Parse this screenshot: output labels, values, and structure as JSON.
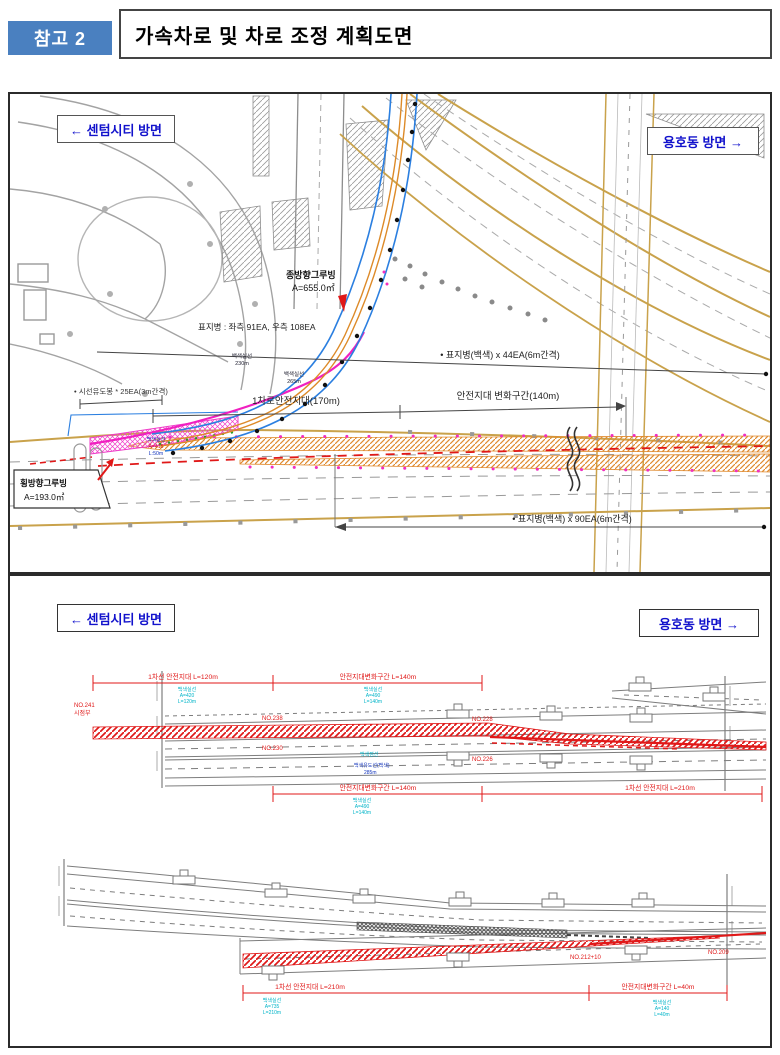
{
  "header": {
    "badge": "참고 2",
    "title": "가속차로 및 차로 조정 계획도면"
  },
  "panel_top": {
    "dir_left": "← 센텀시티 방면",
    "dir_right": "용호동 방면 →",
    "grooving_long_line1": "종방향그루빙",
    "grooving_long_line2": "A=655.0㎡",
    "stud_total": "표지병 : 좌측 91EA, 우측 108EA",
    "stud_white_44": "• 표지병(백색) x 44EA(6m간격)",
    "delineator_25": "• 시선유도봉 * 25EA(3m간격)",
    "lane1_safety_170": "1차로안전지대(170m)",
    "transition_140": "안전지대 변화구간(140m)",
    "stud_white_90": "• 표지병(백색) x 90EA(6m간격)",
    "grooving_cross_line1": "횡방향그루빙",
    "grooving_cross_line2": "A=193.0㎡",
    "white_solid_a_line1": "백색실선",
    "white_solid_a_line2": "230m",
    "white_solid_b_line1": "백색실선",
    "white_solid_b_line2": "265m",
    "white_solid_c_line1": "백색실선",
    "white_solid_c_line2": "A=415",
    "white_solid_c_line3": "L:50m"
  },
  "panel_bottom": {
    "dir_left": "← 센텀시티 방면",
    "dir_right": "용호동 방면 →",
    "d1": {
      "dim_top_left": "1차선 안전지대 L=120m",
      "dim_top_right": "안전지대변화구간 L=140m",
      "dim_bottom_left": "안전지대변화구간 L=140m",
      "dim_bottom_right": "1차선 안전지대 L=210m",
      "cyan_top_left": [
        "백색실선",
        "A=420",
        "L=120m"
      ],
      "cyan_top_right": [
        "백색실선",
        "A=490",
        "L=140m"
      ],
      "cyan_bottom": [
        "백색실선",
        "A=490",
        "L=140m"
      ],
      "sta_start_line1": "NO.241",
      "sta_start_line2": "시점부",
      "sta_a": "NO.238",
      "sta_b": "NO.230",
      "sta_c": "NO.228",
      "sta_d": "NO.226",
      "mid_cyan": "백색점선",
      "mid_navy_line1": "백색유도선(백색)",
      "mid_navy_line2": "285m"
    },
    "d2": {
      "dim_bottom_left": "1차선 안전지대 L=210m",
      "dim_bottom_right": "안전지대변화구간 L=40m",
      "cyan_bottom_left": [
        "백색실선",
        "A=735",
        "L=210m"
      ],
      "cyan_bottom_right": [
        "백색실선",
        "A=140",
        "L=40m"
      ],
      "sta_mid": "NO.212+10",
      "sta_end": "NO.209"
    }
  }
}
